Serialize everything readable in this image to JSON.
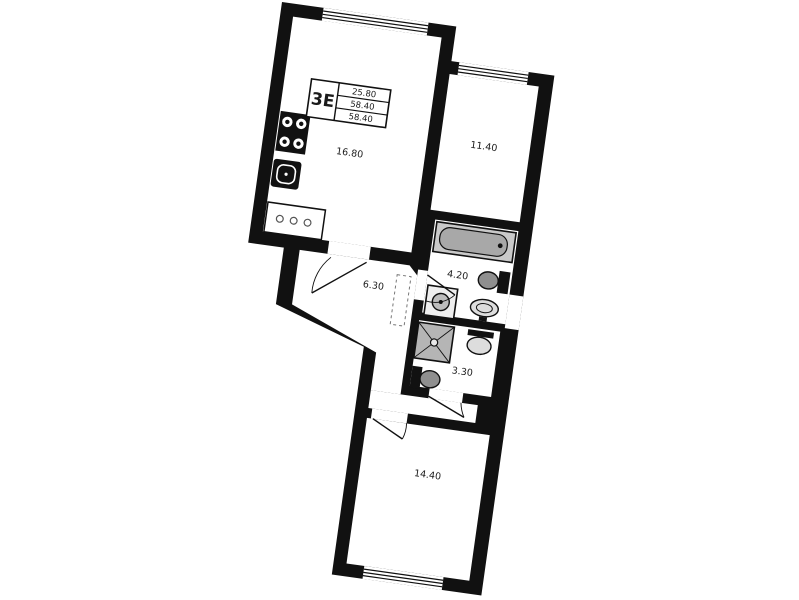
{
  "plan": {
    "unit_label": "3E",
    "title_block": {
      "rows": [
        "25.80",
        "58.40",
        "58.40"
      ]
    },
    "rooms": [
      {
        "name": "kitchen-living-room",
        "area": "16.80"
      },
      {
        "name": "bedroom-upper",
        "area": "11.40"
      },
      {
        "name": "hallway",
        "area": "6.30"
      },
      {
        "name": "bathroom",
        "area": "4.20"
      },
      {
        "name": "shower-wc",
        "area": "3.30"
      },
      {
        "name": "bedroom-lower",
        "area": "14.40"
      }
    ],
    "fixtures": [
      "stove",
      "kitchen-sink",
      "kitchen-counter",
      "bathtub",
      "toilet",
      "washing-machine",
      "sink",
      "shower",
      "wardrobe-dashed"
    ],
    "colors": {
      "walls": "#111111",
      "paper": "#ffffff",
      "fixture_grey": "#a8a8a8",
      "fixture_light": "#d9d9d9"
    }
  }
}
